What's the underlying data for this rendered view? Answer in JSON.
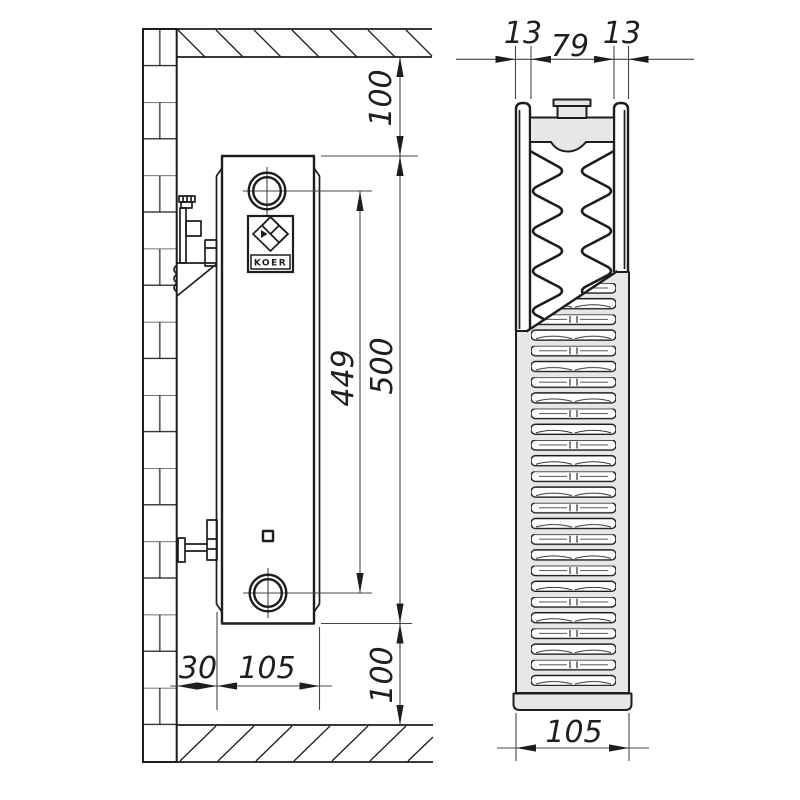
{
  "brand_label": "KOER",
  "side_view": {
    "top_clearance": "100",
    "height": "500",
    "connection_spacing": "449",
    "bottom_clearance": "100",
    "wall_clearance": "30",
    "depth": "105"
  },
  "section_view": {
    "front_panel": "13",
    "convector": "79",
    "rear_panel": "13",
    "depth": "105"
  },
  "colors": {
    "line": "#1d1d1d",
    "dim_line": "#474747",
    "fill_light": "#e7e7e7",
    "background": "#ffffff"
  }
}
